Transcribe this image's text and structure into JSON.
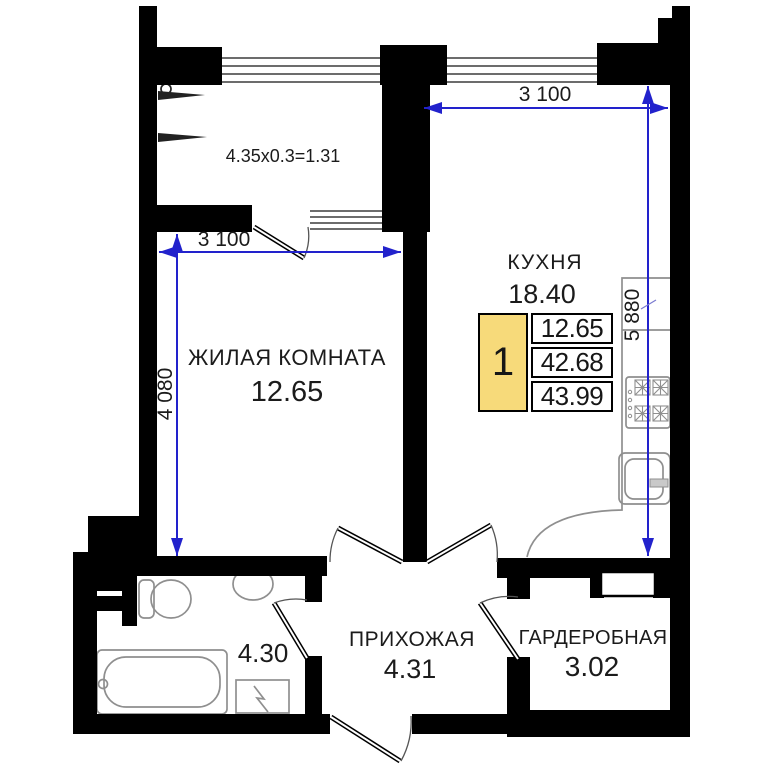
{
  "floor_plan": {
    "type": "apartment-floor-plan",
    "rooms": {
      "kitchen": {
        "name": "КУХНЯ",
        "area": "18.40"
      },
      "living": {
        "name": "ЖИЛАЯ КОМНАТА",
        "area": "12.65"
      },
      "hallway": {
        "name": "ПРИХОЖАЯ",
        "area": "4.31"
      },
      "wardrobe": {
        "name": "ГАРДЕРОБНАЯ",
        "area": "3.02"
      },
      "bathroom": {
        "area": "4.30"
      },
      "balcony": {
        "formula": "4.35x0.3=1.31"
      }
    },
    "dimensions": {
      "living_width": "3 100",
      "living_height": "4 080",
      "kitchen_width": "3 100",
      "kitchen_height": "5 880"
    },
    "info_box": {
      "room_count": "1",
      "values": [
        "12.65",
        "42.68",
        "43.99"
      ]
    },
    "colors": {
      "dimension_blue": "#2222cc",
      "highlight_yellow": "#f7da7a",
      "wall_black": "#000000",
      "fixture_gray": "#8f8f8f"
    }
  }
}
